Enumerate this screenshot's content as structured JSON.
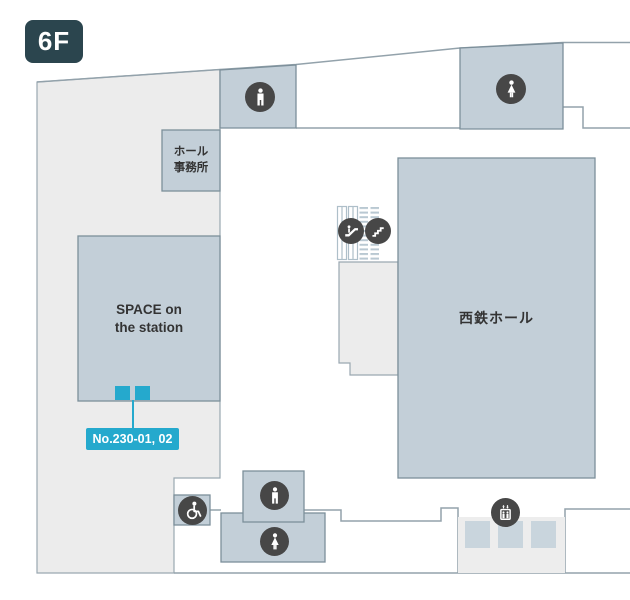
{
  "floor_badge": "6F",
  "colors": {
    "badge_bg": "#2b454e",
    "floor_fill": "#ececec",
    "room_fill": "#c3cfd8",
    "room_border": "#7c8f9a",
    "outline": "#93a2ab",
    "icon_circle_bg": "#474747",
    "accent_cyan": "#25a9cd",
    "text": "#333333"
  },
  "rooms": {
    "hall_office": {
      "label": "ホール事務所",
      "lines": [
        "ホール",
        "事務所"
      ]
    },
    "space_on_the_station": {
      "label": "SPACE on the station",
      "lines": [
        "SPACE on",
        "the station"
      ]
    },
    "nishitetsu_hall": {
      "label": "西鉄ホール"
    }
  },
  "unit_tag": {
    "label": "No.230-01, 02"
  },
  "icons": {
    "mens_restroom": "male-figure-icon",
    "womens_restroom": "female-figure-icon",
    "wheelchair_accessible": "wheelchair-icon",
    "escalator": "escalator-icon",
    "stairs": "stairs-icon",
    "elevator": "elevator-icon"
  }
}
